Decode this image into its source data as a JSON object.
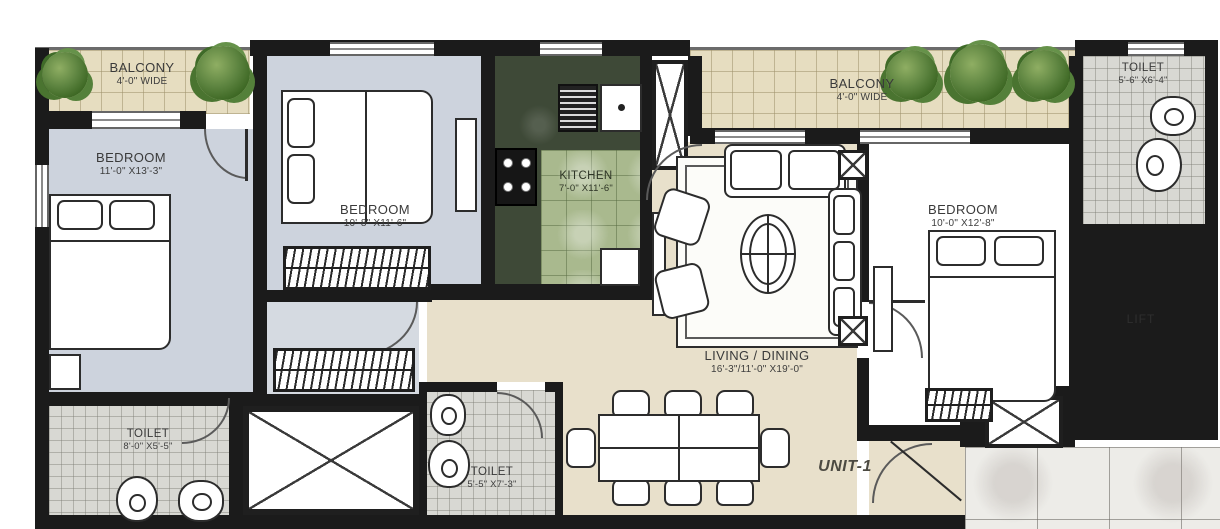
{
  "plan": {
    "unit_label": "UNIT-1",
    "rooms": [
      {
        "id": "balcony-left",
        "name": "BALCONY",
        "dim": "4'-0\" WIDE"
      },
      {
        "id": "bedroom-left",
        "name": "BEDROOM",
        "dim": "11'-0\" X13'-3\""
      },
      {
        "id": "bedroom-middle",
        "name": "BEDROOM",
        "dim": "10'-8\" X11'-6\""
      },
      {
        "id": "kitchen",
        "name": "KITCHEN",
        "dim": "7'-0\" X11'-6\""
      },
      {
        "id": "balcony-right",
        "name": "BALCONY",
        "dim": "4'-0\" WIDE"
      },
      {
        "id": "toilet-top-right",
        "name": "TOILET",
        "dim": "5'-6\" X6'-4\""
      },
      {
        "id": "bedroom-right",
        "name": "BEDROOM",
        "dim": "10'-0\" X12'-8\""
      },
      {
        "id": "living-dining",
        "name": "LIVING / DINING",
        "dim": "16'-3\"/11'-0\" X19'-0\""
      },
      {
        "id": "toilet-bottom-left",
        "name": "TOILET",
        "dim": "8'-0\" X5'-5\""
      },
      {
        "id": "toilet-middle",
        "name": "TOILET",
        "dim": "5'-5\" X7'-3\""
      },
      {
        "id": "lift",
        "name": "LIFT",
        "dim": ""
      }
    ],
    "symbols": [
      "plant",
      "bed",
      "pillow",
      "wardrobe",
      "sofa",
      "armchair",
      "coffee-table",
      "rug",
      "tv-console",
      "dining-table",
      "chair",
      "stove",
      "sink",
      "refrigerator",
      "wc",
      "washbasin",
      "shaft-x",
      "door-arc",
      "window"
    ],
    "colors": {
      "wall": "#1b1b1b",
      "bedroom_floor": "#cdd3dd",
      "living_floor": "#e8e0cb",
      "balcony_tile": "#e6ddc0",
      "kitchen_counter": "#3e4937",
      "kitchen_tile": "#a9b98e",
      "toilet_tile": "#d8d8d3",
      "lift_tile": "#d7ceb5",
      "lobby_marble": "#edece8",
      "plant_green": "#4a7430"
    }
  }
}
